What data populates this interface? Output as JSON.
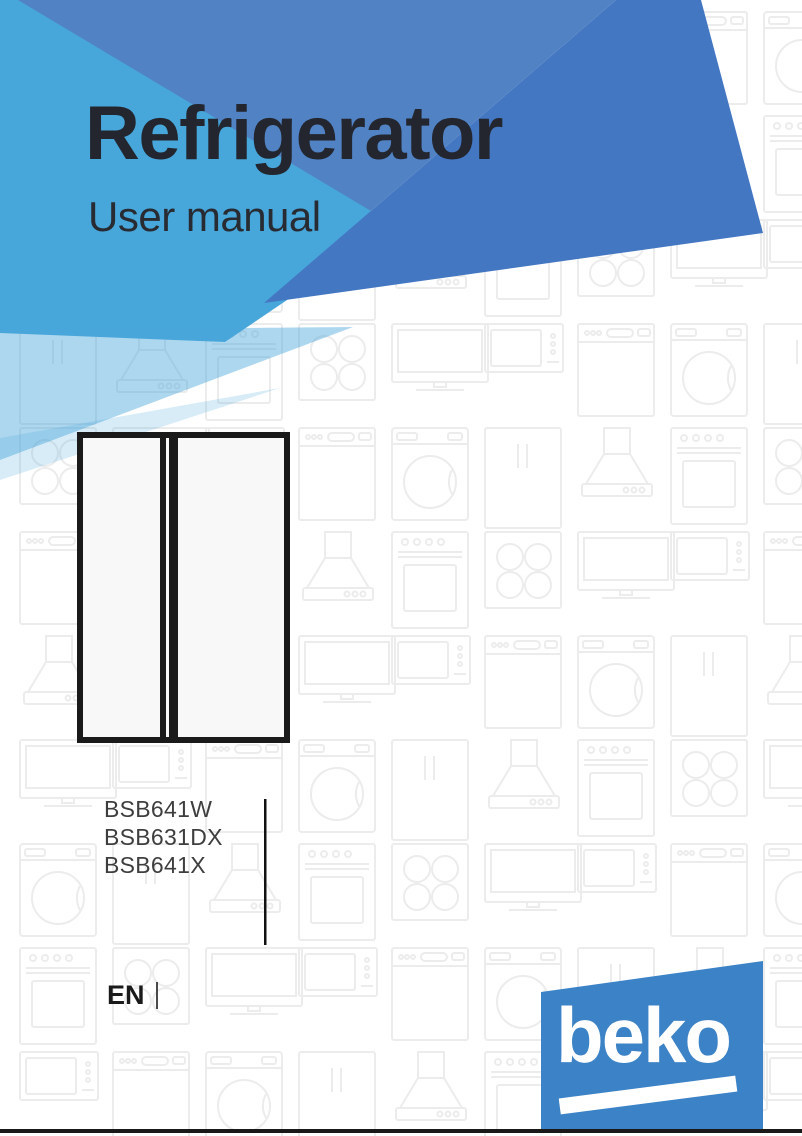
{
  "page": {
    "title": "Refrigerator",
    "subtitle": "User manual"
  },
  "models": {
    "items": [
      "BSB641W",
      "BSB631DX",
      "BSB641X"
    ]
  },
  "language": {
    "code": "EN"
  },
  "brand": {
    "wordmark": "beko"
  },
  "colors": {
    "brand_blue": "#3C82C6",
    "banner_light_blue": "#47A6DA",
    "banner_blue_left": "#5182C4",
    "banner_blue_right": "#4477C2",
    "banner_pale_blue": "rgba(73,167,219,0.45)",
    "pattern_gray": "#ECECEC",
    "title_text": "#23262E",
    "model_text": "#3E3E3E",
    "illustration_black": "#1A1A1A"
  }
}
